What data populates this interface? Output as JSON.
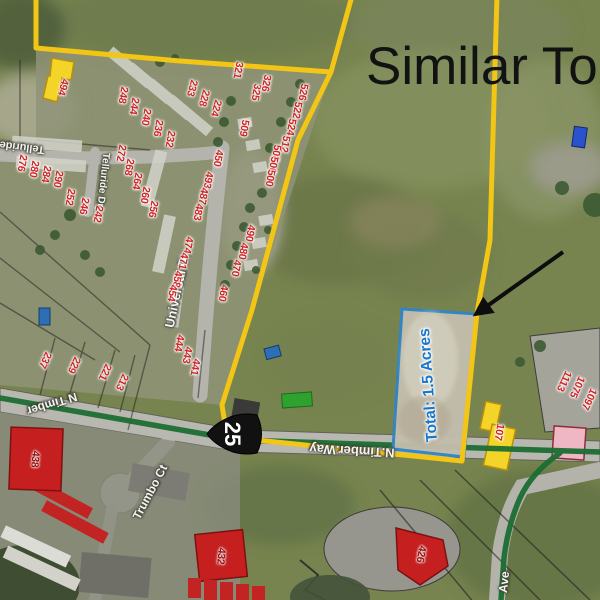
{
  "title": {
    "text": "Similar To"
  },
  "parcel": {
    "acres_label": "Total: 1.5 Acres",
    "outline_color": "#2f86c8",
    "fill_color": "#c3bdac"
  },
  "route_shield": {
    "number": "25",
    "shield_color": "#111111",
    "text_color": "#ffffff"
  },
  "boundary": {
    "color": "#f3c515"
  },
  "route_highlight": {
    "color": "#1b6e33"
  },
  "arrow": {
    "color": "#0d0d0d"
  },
  "address_color": "#cf2525",
  "streets": [
    {
      "t": "Telluride",
      "x": 22,
      "y": 147,
      "r": 187,
      "s": 11
    },
    {
      "t": "Telluride Dr",
      "x": 103,
      "y": 180,
      "r": 96,
      "s": 10
    },
    {
      "t": "Universal Dr",
      "x": 177,
      "y": 290,
      "r": -78,
      "s": 13
    },
    {
      "t": "N Timber",
      "x": 52,
      "y": 404,
      "r": 163,
      "s": 12
    },
    {
      "t": "N.Timber.Way",
      "x": 352,
      "y": 451,
      "r": 183,
      "s": 13
    },
    {
      "t": "Trumbo Ct",
      "x": 150,
      "y": 492,
      "r": -62,
      "s": 12
    },
    {
      "t": "Ave",
      "x": 504,
      "y": 582,
      "r": -84,
      "s": 12
    }
  ],
  "addresses": [
    {
      "n": "248",
      "x": 123,
      "y": 95,
      "r": 100
    },
    {
      "n": "244",
      "x": 134,
      "y": 106,
      "r": 100
    },
    {
      "n": "240",
      "x": 146,
      "y": 117,
      "r": 100
    },
    {
      "n": "236",
      "x": 158,
      "y": 128,
      "r": 100
    },
    {
      "n": "232",
      "x": 170,
      "y": 139,
      "r": 100
    },
    {
      "n": "233",
      "x": 192,
      "y": 88,
      "r": 105
    },
    {
      "n": "228",
      "x": 204,
      "y": 98,
      "r": 105
    },
    {
      "n": "224",
      "x": 216,
      "y": 108,
      "r": 105
    },
    {
      "n": "321",
      "x": 238,
      "y": 70,
      "r": 100
    },
    {
      "n": "325",
      "x": 256,
      "y": 92,
      "r": 100
    },
    {
      "n": "326",
      "x": 266,
      "y": 83,
      "r": 100
    },
    {
      "n": "509",
      "x": 244,
      "y": 128,
      "r": 100
    },
    {
      "n": "526",
      "x": 303,
      "y": 92,
      "r": 100
    },
    {
      "n": "522",
      "x": 297,
      "y": 110,
      "r": 100
    },
    {
      "n": "524",
      "x": 291,
      "y": 127,
      "r": 100
    },
    {
      "n": "512",
      "x": 285,
      "y": 144,
      "r": 100
    },
    {
      "n": "508",
      "x": 276,
      "y": 153,
      "r": 100
    },
    {
      "n": "506",
      "x": 273,
      "y": 165,
      "r": 100
    },
    {
      "n": "500",
      "x": 270,
      "y": 178,
      "r": 100
    },
    {
      "n": "490",
      "x": 250,
      "y": 233,
      "r": 100
    },
    {
      "n": "480",
      "x": 243,
      "y": 251,
      "r": 100
    },
    {
      "n": "470",
      "x": 236,
      "y": 268,
      "r": 100
    },
    {
      "n": "460",
      "x": 223,
      "y": 293,
      "r": 100
    },
    {
      "n": "450",
      "x": 218,
      "y": 158,
      "r": 100
    },
    {
      "n": "493",
      "x": 208,
      "y": 180,
      "r": 100
    },
    {
      "n": "487",
      "x": 203,
      "y": 196,
      "r": 100
    },
    {
      "n": "483",
      "x": 198,
      "y": 212,
      "r": 100
    },
    {
      "n": "474",
      "x": 188,
      "y": 245,
      "r": 100
    },
    {
      "n": "471",
      "x": 183,
      "y": 261,
      "r": 100
    },
    {
      "n": "458",
      "x": 177,
      "y": 279,
      "r": 100
    },
    {
      "n": "454",
      "x": 172,
      "y": 293,
      "r": 100
    },
    {
      "n": "272",
      "x": 121,
      "y": 153,
      "r": 100
    },
    {
      "n": "268",
      "x": 129,
      "y": 167,
      "r": 100
    },
    {
      "n": "264",
      "x": 137,
      "y": 181,
      "r": 100
    },
    {
      "n": "260",
      "x": 145,
      "y": 195,
      "r": 100
    },
    {
      "n": "256",
      "x": 153,
      "y": 209,
      "r": 100
    },
    {
      "n": "276",
      "x": 22,
      "y": 163,
      "r": 100
    },
    {
      "n": "280",
      "x": 34,
      "y": 169,
      "r": 100
    },
    {
      "n": "284",
      "x": 46,
      "y": 174,
      "r": 100
    },
    {
      "n": "290",
      "x": 58,
      "y": 179,
      "r": 100
    },
    {
      "n": "252",
      "x": 70,
      "y": 197,
      "r": 100
    },
    {
      "n": "246",
      "x": 84,
      "y": 206,
      "r": 100
    },
    {
      "n": "242",
      "x": 98,
      "y": 214,
      "r": 100
    },
    {
      "n": "237",
      "x": 45,
      "y": 360,
      "r": 115
    },
    {
      "n": "229",
      "x": 74,
      "y": 365,
      "r": 115
    },
    {
      "n": "221",
      "x": 105,
      "y": 372,
      "r": 115
    },
    {
      "n": "213",
      "x": 122,
      "y": 382,
      "r": 115
    },
    {
      "n": "444",
      "x": 179,
      "y": 343,
      "r": 100
    },
    {
      "n": "443",
      "x": 187,
      "y": 355,
      "r": 100
    },
    {
      "n": "441",
      "x": 195,
      "y": 367,
      "r": 100
    },
    {
      "n": "494",
      "x": 63,
      "y": 87,
      "r": 105
    },
    {
      "n": "1113",
      "x": 564,
      "y": 381,
      "r": 115
    },
    {
      "n": "1075",
      "x": 577,
      "y": 387,
      "r": 115
    },
    {
      "n": "1097",
      "x": 589,
      "y": 399,
      "r": 115
    },
    {
      "n": "107",
      "x": 499,
      "y": 432,
      "r": 100
    },
    {
      "n": "438",
      "x": 35,
      "y": 459,
      "r": 95,
      "c": "b"
    },
    {
      "n": "432",
      "x": 221,
      "y": 556,
      "r": 95,
      "c": "b"
    },
    {
      "n": "426",
      "x": 421,
      "y": 554,
      "r": 100,
      "c": "b"
    }
  ]
}
